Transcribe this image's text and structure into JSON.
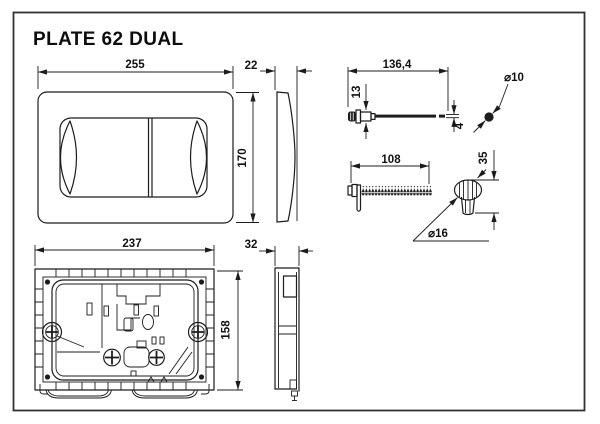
{
  "title": "PLATE 62 DUAL",
  "views": {
    "plate_front": {
      "width": "255",
      "height": "170"
    },
    "plate_side": {
      "thickness": "22"
    },
    "push_rod": {
      "length": "136,4",
      "head_height": "13",
      "rod_diameter": "4",
      "ball_diameter": "⌀10"
    },
    "threaded_rod": {
      "length": "108"
    },
    "adjuster_knob": {
      "height": "35",
      "diameter": "⌀16"
    },
    "frame_back": {
      "width": "237",
      "height": "158"
    },
    "frame_side": {
      "thickness": "32"
    }
  },
  "colors": {
    "line": "#1c1c1c",
    "background": "#ffffff",
    "sheet_border": "#333333"
  }
}
